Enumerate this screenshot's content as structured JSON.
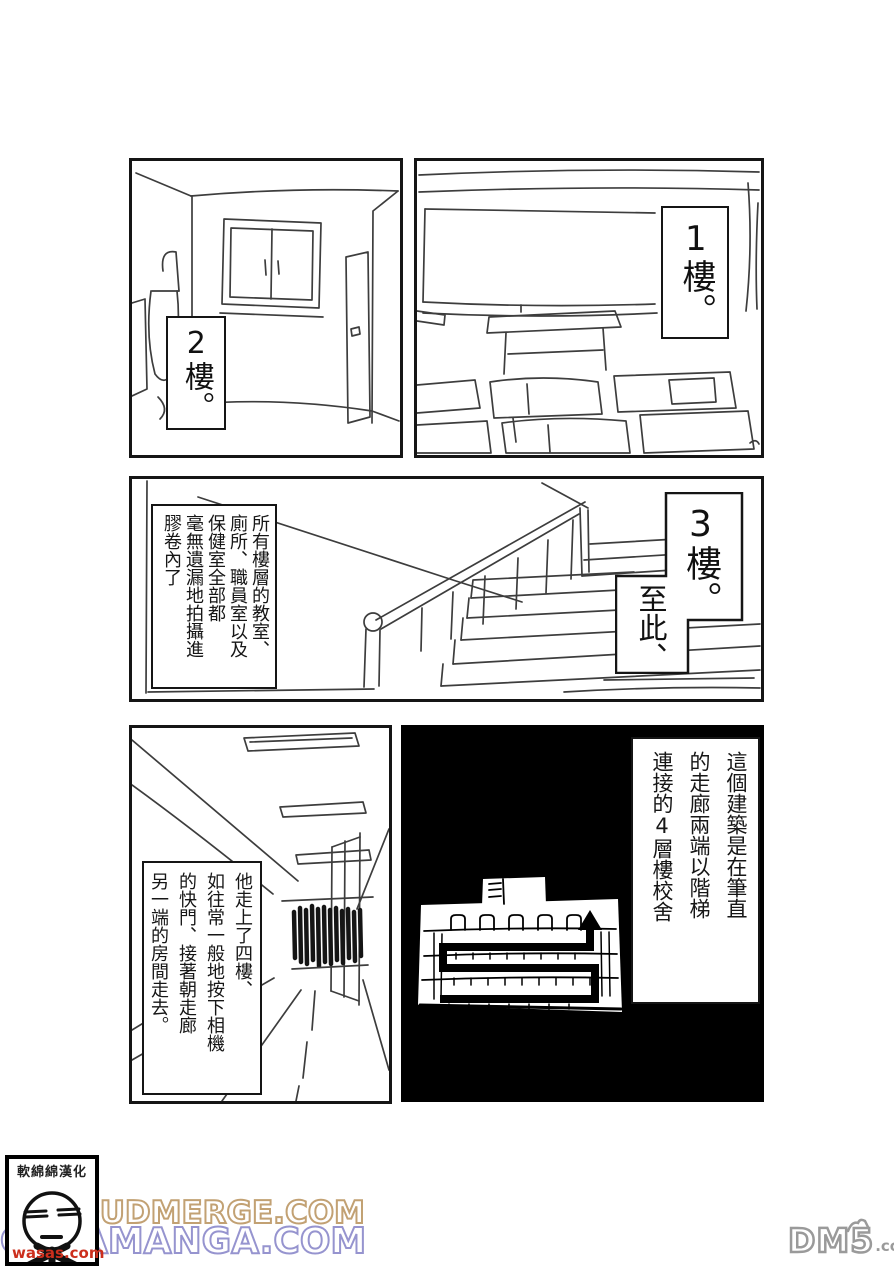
{
  "colors": {
    "ink": "#3d3d3d",
    "panel_border": "#151515",
    "black_panel_bg": "#000000",
    "watermark_tan": "#c2a173",
    "watermark_purple": "#9694cf",
    "watermark_red": "#cc2f1d",
    "dm5_gray": "#9a9a9a"
  },
  "panels": {
    "room": {
      "floor_label": "2樓。"
    },
    "classroom": {
      "floor_label": "1樓。"
    },
    "stairs": {
      "caption_columns": [
        "所有樓層的教室、",
        "廁所、職員室以及",
        "保健室全部都",
        "毫無遺漏地拍攝進",
        "膠卷內了"
      ],
      "floor_label": "3樓。",
      "sub_label": "至此、"
    },
    "corridor": {
      "caption_columns": [
        "他走上了四樓、",
        "如往常一般地按下相機",
        "的快門、接著朝走廊",
        "另一端的房間走去。"
      ]
    },
    "floor_map": {
      "caption_columns": [
        "這個建築是在筆直",
        "的走廊兩端以階梯",
        "連接的4層樓校舍"
      ]
    }
  },
  "footer": {
    "scanlation_group": "軟綿綿漢化",
    "watermark_line1": "ACLOUDMERGE.COM",
    "watermark_line2": "COLAMANGA.COM",
    "watermark_small": "wasas.com",
    "site_name": "DM5",
    "site_suffix": ".com"
  }
}
